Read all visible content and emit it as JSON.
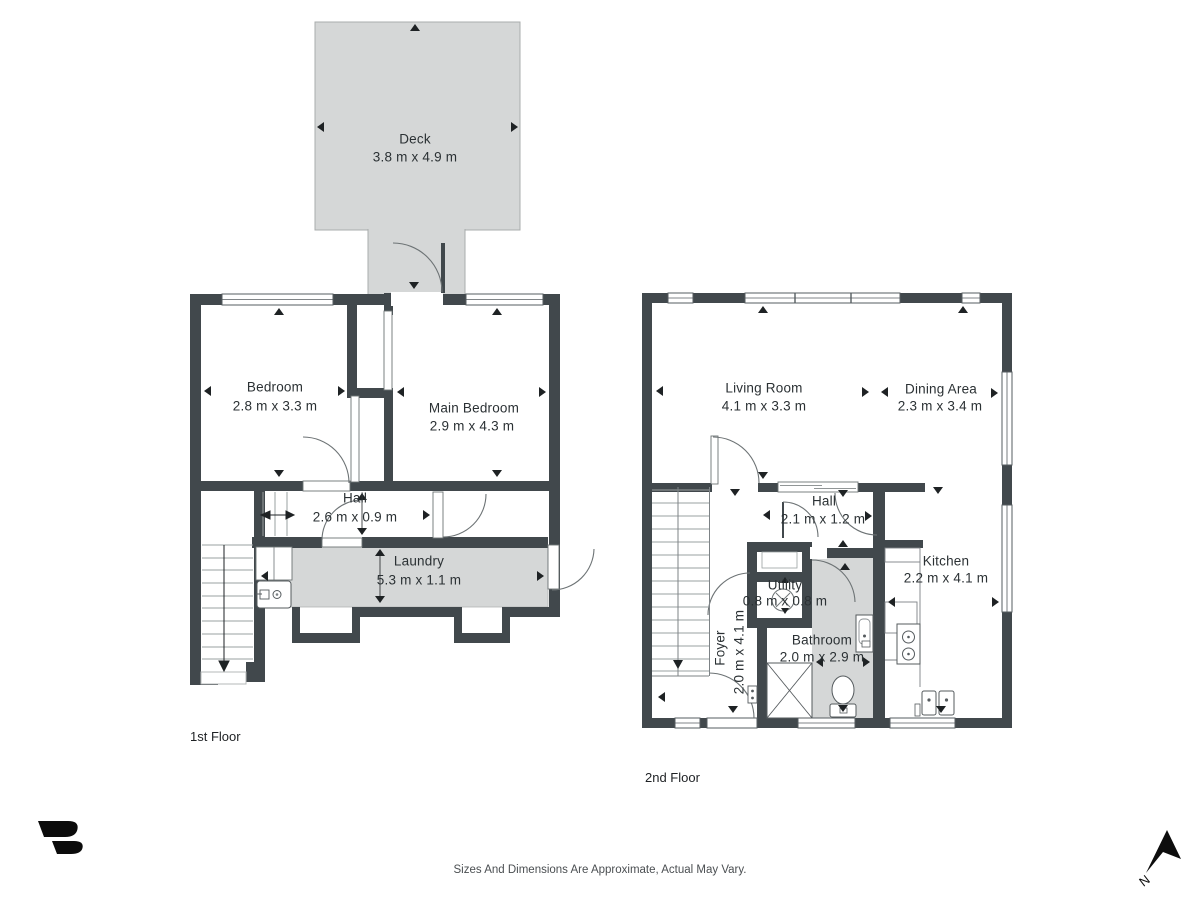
{
  "floors": [
    {
      "label": "1st Floor",
      "rooms": [
        {
          "name": "Deck",
          "dims": "3.8 m x 4.9 m"
        },
        {
          "name": "Bedroom",
          "dims": "2.8 m x 3.3 m"
        },
        {
          "name": "Main Bedroom",
          "dims": "2.9 m x 4.3 m"
        },
        {
          "name": "Hall",
          "dims": "2.6 m x 0.9 m"
        },
        {
          "name": "Laundry",
          "dims": "5.3 m x 1.1 m"
        }
      ]
    },
    {
      "label": "2nd Floor",
      "rooms": [
        {
          "name": "Living Room",
          "dims": "4.1 m x 3.3 m"
        },
        {
          "name": "Dining Area",
          "dims": "2.3 m x 3.4 m"
        },
        {
          "name": "Hall",
          "dims": "2.1 m x 1.2 m"
        },
        {
          "name": "Utility",
          "dims": "0.8 m x 0.8 m"
        },
        {
          "name": "Bathroom",
          "dims": "2.0 m x 2.9 m"
        },
        {
          "name": "Foyer",
          "dims": "2.0 m x 4.1 m"
        },
        {
          "name": "Kitchen",
          "dims": "2.2 m x 4.1 m"
        }
      ]
    }
  ],
  "footer": "Sizes And Dimensions Are Approximate, Actual May Vary.",
  "compass_label": "N",
  "icons": [
    "washer-icon",
    "toilet-icon",
    "shower-icon",
    "bath-sink-icon",
    "stove-icon",
    "kitchen-sink-icon",
    "fan-icon",
    "compass-north-icon",
    "brand-logo-icon"
  ],
  "colors": {
    "wall": "#41484c",
    "room_fill": "#d5d7d7",
    "detail_line": "#6d7375",
    "arrow": "#1e2224"
  }
}
